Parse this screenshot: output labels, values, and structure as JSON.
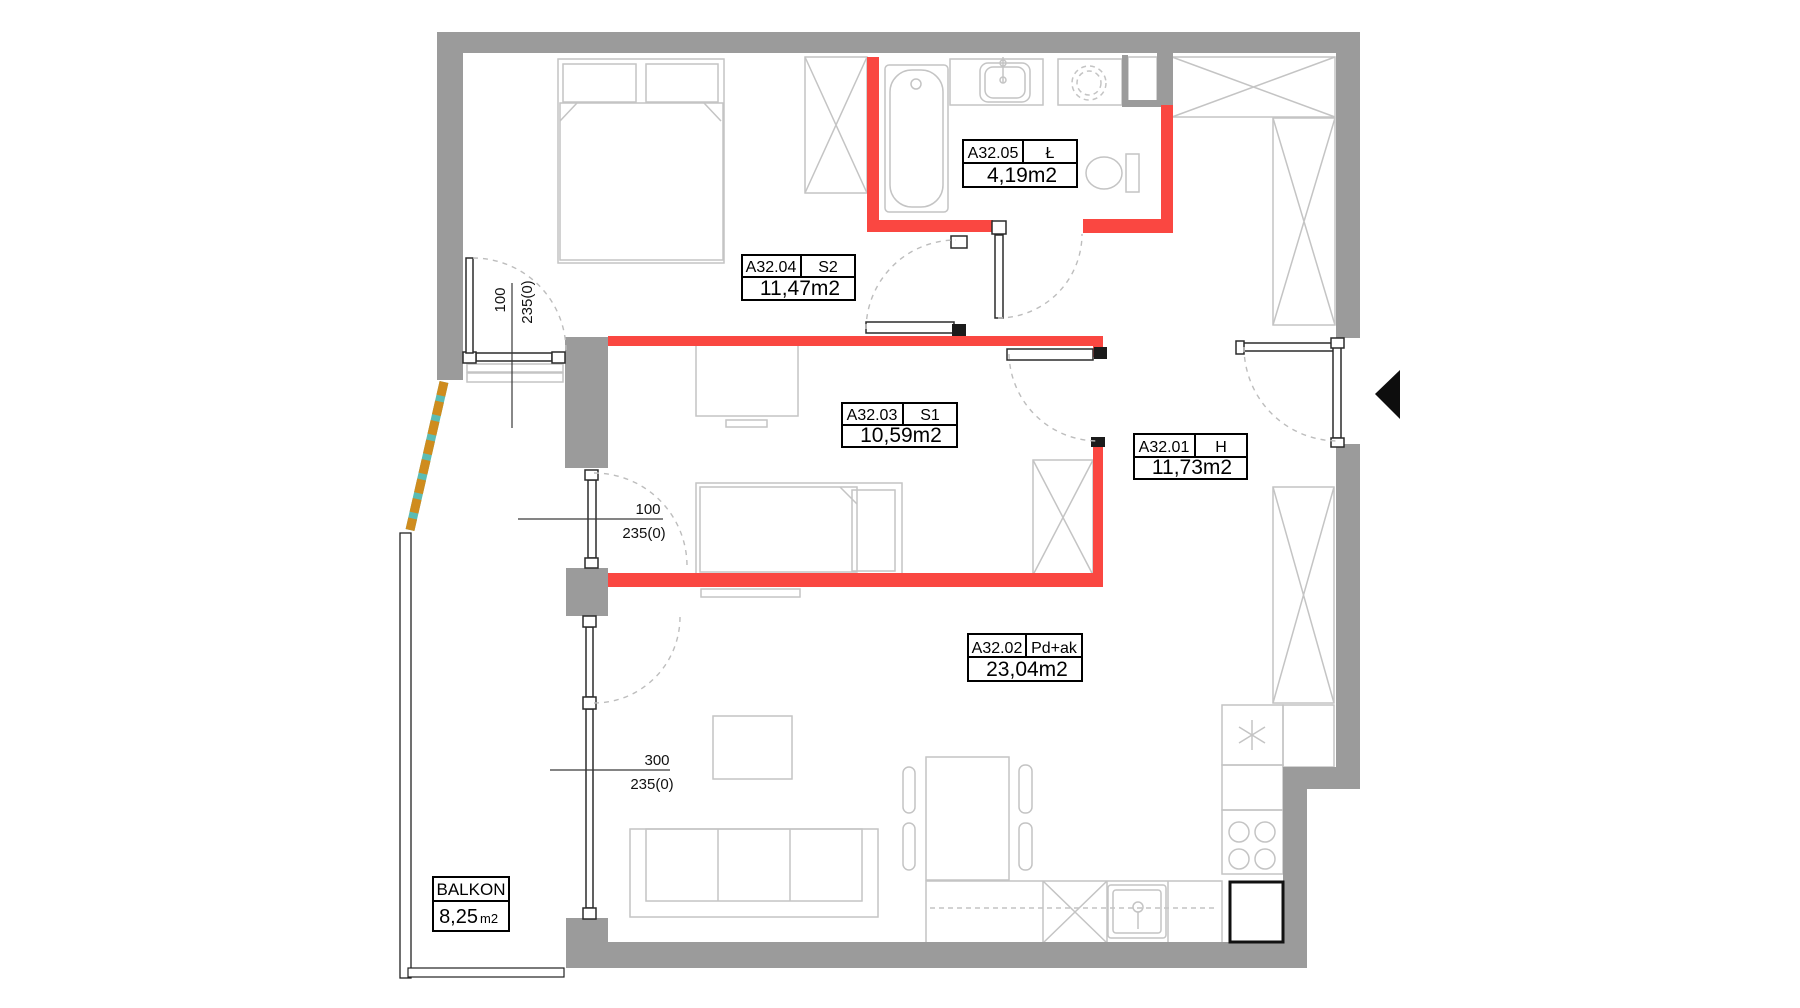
{
  "rooms": {
    "hall": {
      "code": "A32.01",
      "name": "H",
      "area": "11,73m2"
    },
    "living": {
      "code": "A32.02",
      "name": "Pd+ak",
      "area": "23,04m2"
    },
    "s1": {
      "code": "A32.03",
      "name": "S1",
      "area": "10,59m2"
    },
    "s2": {
      "code": "A32.04",
      "name": "S2",
      "area": "11,47m2"
    },
    "bath": {
      "code": "A32.05",
      "name": "Ł",
      "area": "4,19m2"
    }
  },
  "balcony": {
    "label": "BALKON",
    "area": "8,25",
    "unit": "m2"
  },
  "dimensions": {
    "s2_door": {
      "width": "100",
      "height": "235(0)"
    },
    "s1_door": {
      "width": "100",
      "height": "235(0)"
    },
    "living_window": {
      "width": "300",
      "height": "235(0)"
    }
  },
  "colors": {
    "wall": "#9b9b9b",
    "red": "#fa4741",
    "furniture": "#c4c4c4",
    "divider_orange": "#cf8c1e",
    "divider_teal": "#5bbcb4"
  }
}
